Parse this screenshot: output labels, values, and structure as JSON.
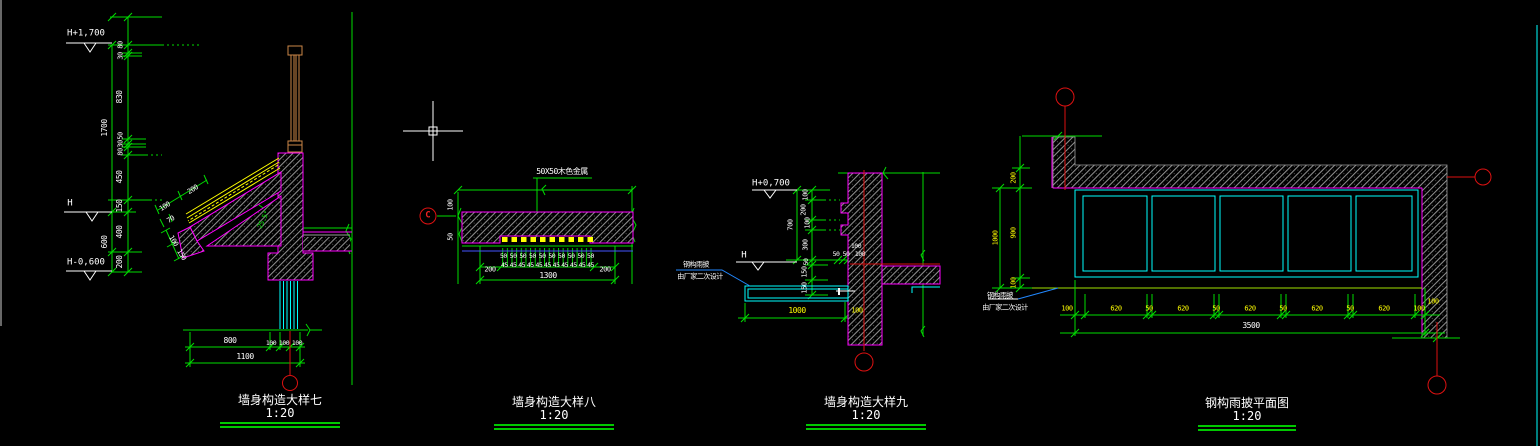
{
  "app": {
    "type": "cad-drawing-canvas"
  },
  "colors": {
    "background": "#000000",
    "dimension_green": "#00dd00",
    "outline_magenta": "#ff00ff",
    "steel_cyan": "#00ffff",
    "dim_yellow": "#ffff00",
    "axis_red": "#dd1111",
    "wood_tan": "#cd8748",
    "leader_blue": "#2288ff",
    "hatch_gray": "#909090",
    "title_underline": "#00c800"
  },
  "d7": {
    "title": "墙身构造大样七",
    "scale": "1:20",
    "elev_top": "H+1,700",
    "elev_mid": "H",
    "elev_bot": "H-0,600",
    "outer_dims": [
      "1700",
      "600"
    ],
    "chain_dims": [
      "80",
      "30",
      "830",
      "50",
      "30",
      "80",
      "450",
      "150",
      "400",
      "200"
    ],
    "slope_dims": [
      "100",
      "200",
      "70",
      "100",
      "150"
    ],
    "angle": "25.5°",
    "bottom_dims": [
      "800",
      "100",
      "100",
      "100"
    ],
    "bottom_total": "1100"
  },
  "d8": {
    "title": "墙身构造大样八",
    "scale": "1:20",
    "label": "50X50木色金属",
    "bubble": "C",
    "side_dims": [
      "100",
      "50"
    ],
    "row50": [
      "50",
      "50",
      "50",
      "50",
      "50",
      "50",
      "50",
      "50",
      "50",
      "50"
    ],
    "row45": [
      "45",
      "45",
      "45",
      "45",
      "45",
      "45",
      "45",
      "45",
      "45",
      "45",
      "45"
    ],
    "end_left": "200",
    "end_right": "200",
    "total": "1300"
  },
  "d9": {
    "title": "墙身构造大样九",
    "scale": "1:20",
    "elev_top": "H+0,700",
    "elev_mid": "H",
    "outer_dim": "700",
    "chain_dims": [
      "100",
      "200",
      "100",
      "300"
    ],
    "lower_dims": [
      "50",
      "150",
      "150"
    ],
    "wall_dim_top": "100",
    "wall_dims": [
      "50",
      "50",
      "100"
    ],
    "note1": "钢构雨披",
    "note2": "由厂家二次设计",
    "dim_1000": "1000",
    "dim_100": "100"
  },
  "plan": {
    "title": "钢构雨披平面图",
    "scale": "1:20",
    "left_dims": [
      "200",
      "900",
      "100"
    ],
    "left_total": "1000",
    "note1": "钢构雨披",
    "note2": "由厂家二次设计",
    "bottom_dims": [
      "100",
      "620",
      "50",
      "620",
      "50",
      "620",
      "50",
      "620",
      "50",
      "620",
      "100"
    ],
    "wall_dim": "100",
    "bottom_total": "3500"
  }
}
